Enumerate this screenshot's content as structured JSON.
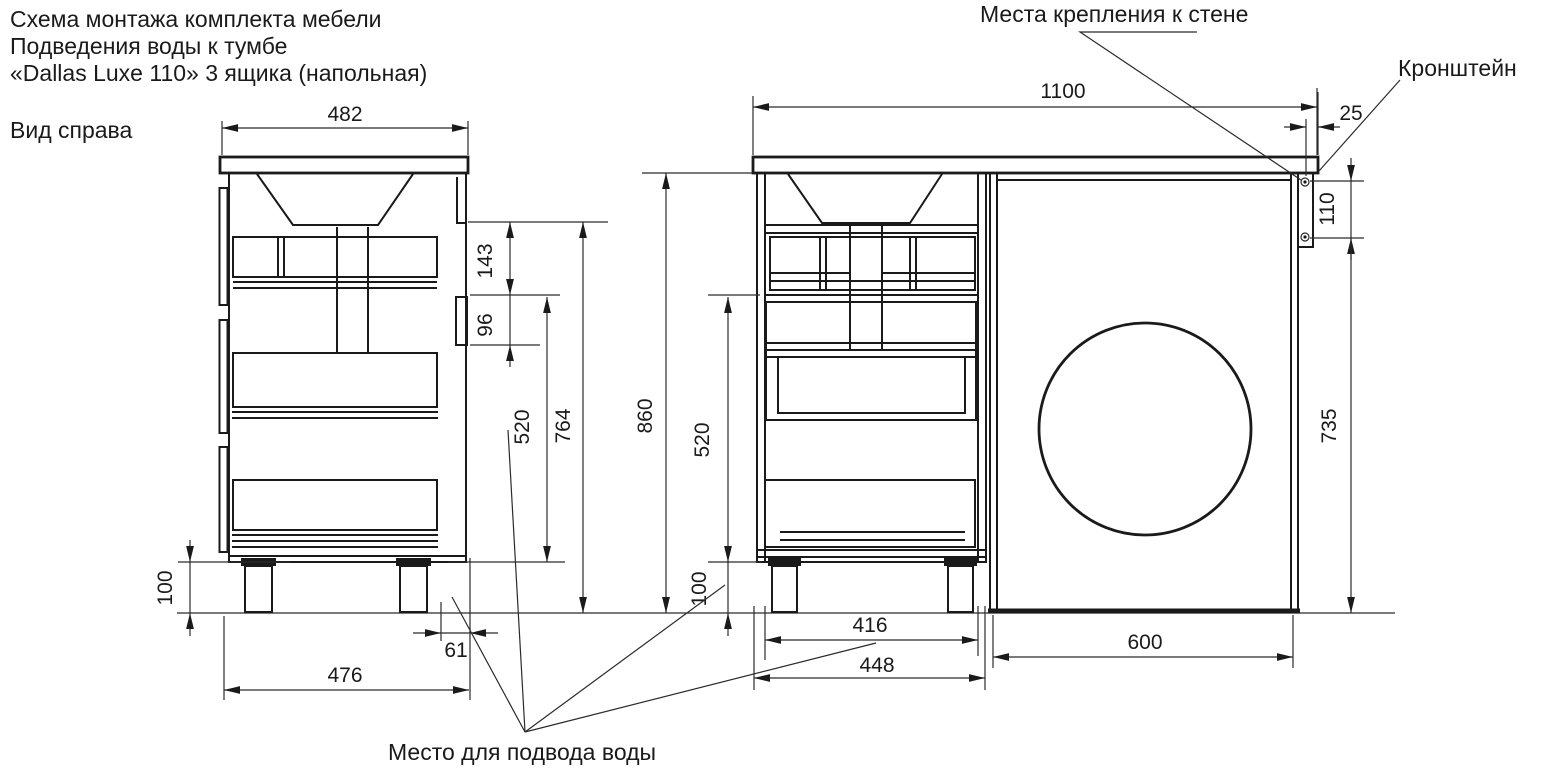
{
  "title": {
    "line1": "Схема монтажа комплекта мебели",
    "line2": "Подведения воды к тумбе",
    "line3": "«Dallas Luxe 110» 3 ящика (напольная)"
  },
  "view_label": "Вид справа",
  "callouts": {
    "wall_mount": "Места крепления к стене",
    "bracket": "Кронштейн",
    "water_supply": "Место для подвода воды"
  },
  "dimensions_mm": {
    "side_view": {
      "countertop_depth": "482",
      "top_to_inlet": "143",
      "inlet_height": "96",
      "drawer_zone": "520",
      "body_height": "764",
      "total_height": "860",
      "legs": "100",
      "back_offset": "61",
      "base_depth": "476"
    },
    "front_view": {
      "countertop_width": "1100",
      "side_overhang": "25",
      "bracket_holes": "110",
      "niche_height": "735",
      "drawer_zone": "520",
      "legs": "100",
      "inner_width": "416",
      "cabinet_width": "448",
      "niche_width": "600"
    }
  },
  "colors": {
    "line": "#1a1a1a",
    "background": "#ffffff"
  }
}
